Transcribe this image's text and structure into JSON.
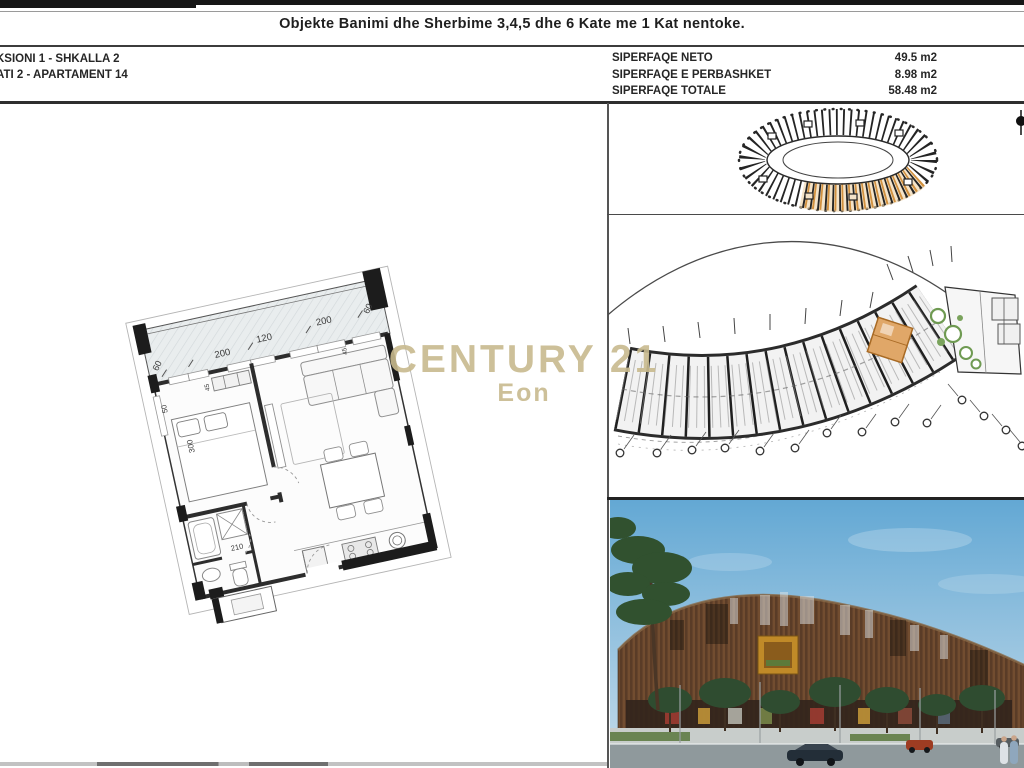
{
  "header": {
    "title": "Objekte Banimi dhe Sherbime 3,4,5 dhe 6 Kate me 1 Kat nentoke.",
    "section_line1": "KSIONI 1 - SHKALLA 2",
    "section_line2": "ATI 2 - APARTAMENT 14",
    "areas": [
      {
        "label": "SIPERFAQE NETO",
        "value": "49.5 m2"
      },
      {
        "label": "SIPERFAQE E PERBASHKET",
        "value": "8.98 m2"
      },
      {
        "label": "SIPERFAQE TOTALE",
        "value": "58.48 m2"
      }
    ]
  },
  "watermark": {
    "brand": "CENTURY 21",
    "agency": "Eon",
    "color": "#c8ba8e"
  },
  "floor_plan": {
    "dims": [
      "60",
      "200",
      "120",
      "200",
      "60",
      "45",
      "45",
      "50",
      "300",
      "210"
    ]
  },
  "site_overview": {
    "highlight_color": "#d2913f"
  },
  "key_plan": {
    "highlight_color": "#e0a768"
  }
}
